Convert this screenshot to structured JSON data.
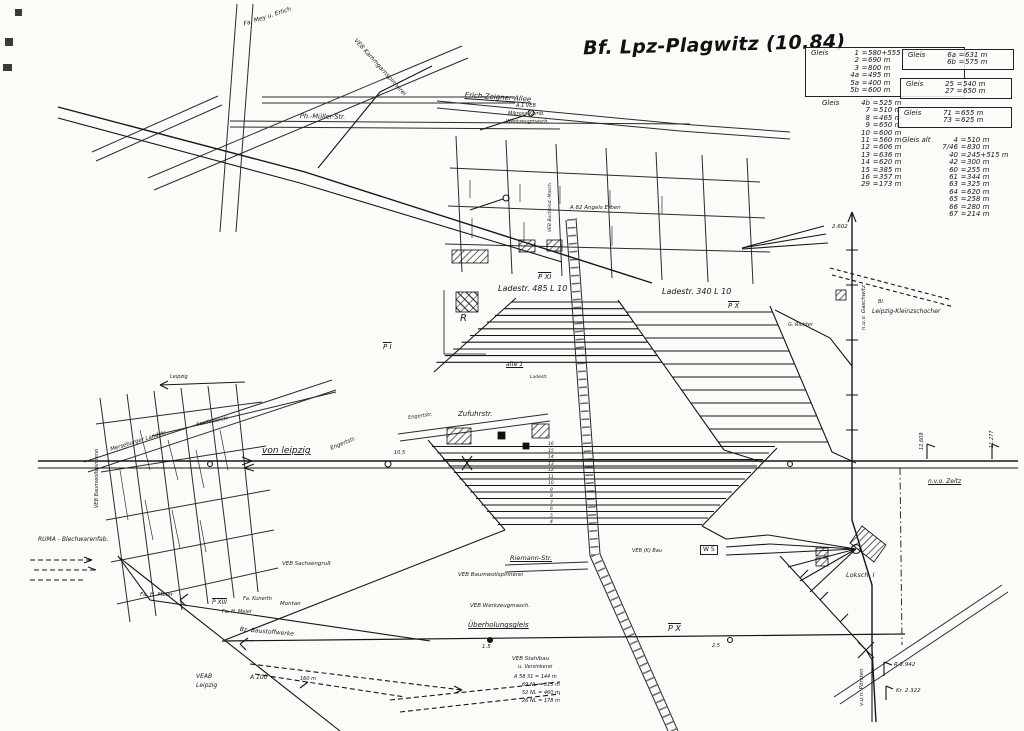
{
  "title": "Bf. Lpz-Plagwitz (10.84)",
  "colors": {
    "ink": "#181818",
    "paper": "#fbfbf8"
  },
  "tables": {
    "gleis_box_1": {
      "heading": "Gleis",
      "rows": [
        [
          "1",
          "580+555 m"
        ],
        [
          "2",
          "690 m"
        ],
        [
          "3",
          "800 m"
        ],
        [
          "4a",
          "495 m"
        ],
        [
          "5a",
          "400 m"
        ],
        [
          "5b",
          "600 m"
        ]
      ]
    },
    "gleis_list_1": {
      "heading": "Gleis",
      "rows": [
        [
          "4b",
          "525 m"
        ],
        [
          "7",
          "510 m"
        ],
        [
          "8",
          "465 m"
        ],
        [
          "9",
          "650 m"
        ],
        [
          "10",
          "600 m"
        ],
        [
          "11",
          "560 m"
        ],
        [
          "12",
          "606 m"
        ],
        [
          "13",
          "636 m"
        ],
        [
          "14",
          "620 m"
        ],
        [
          "15",
          "385 m"
        ],
        [
          "16",
          "357 m"
        ],
        [
          "29",
          "173 m"
        ]
      ]
    },
    "gleis_box_2": {
      "heading": "Gleis",
      "rows": [
        [
          "6a",
          "631 m"
        ],
        [
          "6b",
          "575 m"
        ]
      ]
    },
    "gleis_box_3": {
      "heading": "Gleis",
      "rows": [
        [
          "25",
          "540 m"
        ],
        [
          "27",
          "650 m"
        ]
      ]
    },
    "gleis_box_4": {
      "heading": "Gleis",
      "rows": [
        [
          "71",
          "655 m"
        ],
        [
          "73",
          "625 m"
        ]
      ]
    },
    "gleis_list_2": {
      "heading": "Gleis alt",
      "rows": [
        [
          "4",
          "510 m"
        ],
        [
          "7/46",
          "830 m"
        ],
        [
          "40",
          "245+515 m"
        ],
        [
          "42",
          "300 m"
        ],
        [
          "60",
          "255 m"
        ],
        [
          "61",
          "344 m"
        ],
        [
          "63",
          "325 m"
        ],
        [
          "64",
          "620 m"
        ],
        [
          "65",
          "258 m"
        ],
        [
          "66",
          "280 m"
        ],
        [
          "67",
          "214 m"
        ]
      ]
    }
  },
  "map": {
    "labels": [
      {
        "t": "Erich-Zeigner-Allee",
        "x": 465,
        "y": 92,
        "s": 7,
        "r": 4,
        "u": 1,
        "n": "street-label-erich-zeigner-allee"
      },
      {
        "t": "Ph.-Müller-Str.",
        "x": 300,
        "y": 113,
        "s": 6.5,
        "r": 1,
        "n": "street-label-ph-mueller-str"
      },
      {
        "t": "Fa. Mey u. Erlich",
        "x": 243,
        "y": 22,
        "s": 6,
        "r": -18,
        "n": "factory-label"
      },
      {
        "t": "VEB Kammgarnspinnerei",
        "x": 357,
        "y": 38,
        "s": 6,
        "r": 48,
        "n": "factory-label"
      },
      {
        "t": "A.1 VEB",
        "x": 516,
        "y": 104,
        "s": 5,
        "n": "factory-label"
      },
      {
        "t": "Mikrosa Komb.",
        "x": 508,
        "y": 112,
        "s": 5,
        "n": "factory-label"
      },
      {
        "t": "Werkzeugmasch.",
        "x": 506,
        "y": 120,
        "s": 5,
        "n": "factory-label"
      },
      {
        "t": "A 82 Angels Erben",
        "x": 570,
        "y": 206,
        "s": 5.5,
        "n": "factory-label"
      },
      {
        "t": "VEB Buchbind.-Masch.",
        "x": 549,
        "y": 232,
        "s": 4.5,
        "r": -90,
        "n": "factory-label"
      },
      {
        "t": "Ladestr. 485  L 10",
        "x": 498,
        "y": 285,
        "s": 8,
        "n": "ladestrasse-485-label"
      },
      {
        "t": "Ladestr. 340  L 10",
        "x": 662,
        "y": 288,
        "s": 8,
        "n": "ladestrasse-340-label"
      },
      {
        "t": "P XI",
        "x": 538,
        "y": 274,
        "s": 7,
        "o": 1,
        "n": "post-label-p11"
      },
      {
        "t": "P X",
        "x": 728,
        "y": 303,
        "s": 7,
        "o": 1,
        "n": "post-label-p10"
      },
      {
        "t": "P I",
        "x": 383,
        "y": 344,
        "s": 7,
        "o": 1,
        "n": "post-label-p1"
      },
      {
        "t": "R",
        "x": 460,
        "y": 314,
        "s": 10,
        "n": "ramp-label"
      },
      {
        "t": "alte 1",
        "x": 506,
        "y": 362,
        "s": 6,
        "u": 1,
        "n": "track-label-alte-1"
      },
      {
        "t": "Ladestr.",
        "x": 530,
        "y": 376,
        "s": 4.5,
        "n": "ladestrasse-small-label"
      },
      {
        "t": "Zufuhrstr.",
        "x": 458,
        "y": 411,
        "s": 7,
        "n": "street-label-zufuhrstr"
      },
      {
        "t": "Engertstr.",
        "x": 330,
        "y": 447,
        "s": 5.5,
        "r": -22,
        "n": "street-label-engertstr"
      },
      {
        "t": "Engertstr.",
        "x": 408,
        "y": 416,
        "s": 5,
        "r": -8,
        "n": "street-label-engertstr-2"
      },
      {
        "t": "von leipzig",
        "x": 262,
        "y": 447,
        "s": 9,
        "u": 1,
        "n": "direction-label-von-leipzig"
      },
      {
        "t": "Leipzig",
        "x": 170,
        "y": 375,
        "s": 5,
        "n": "direction-label-leipzig"
      },
      {
        "t": "Merseburger Landstr.",
        "x": 110,
        "y": 448,
        "s": 5.5,
        "r": -17,
        "n": "street-label-merseburger"
      },
      {
        "t": "Saalfelderstr.",
        "x": 196,
        "y": 423,
        "s": 5,
        "r": -12,
        "n": "street-label-saalfelder"
      },
      {
        "t": "VEB Baumwollspinnerei",
        "x": 95,
        "y": 508,
        "s": 5,
        "r": -90,
        "n": "factory-label"
      },
      {
        "t": "RUMA - Blechwarenfab.",
        "x": 38,
        "y": 537,
        "s": 6,
        "n": "factory-label-ruma"
      },
      {
        "t": "Fa. H. Meier",
        "x": 140,
        "y": 593,
        "s": 5.5,
        "n": "factory-label"
      },
      {
        "t": "P XIII",
        "x": 212,
        "y": 600,
        "s": 6,
        "o": 1,
        "n": "post-label-p13"
      },
      {
        "t": "Fa. H. Meier",
        "x": 222,
        "y": 610,
        "s": 5,
        "n": "factory-label"
      },
      {
        "t": "Fa. Kunerth",
        "x": 243,
        "y": 597,
        "s": 5,
        "n": "factory-label"
      },
      {
        "t": "Montan",
        "x": 280,
        "y": 602,
        "s": 5.5,
        "n": "factory-label"
      },
      {
        "t": "VEB Sachsengruß",
        "x": 282,
        "y": 562,
        "s": 5.5,
        "n": "factory-label"
      },
      {
        "t": "Bz. Baustoffwerke",
        "x": 240,
        "y": 627,
        "s": 6,
        "r": 5,
        "n": "factory-label"
      },
      {
        "t": "VEAB",
        "x": 196,
        "y": 674,
        "s": 6,
        "n": "factory-label-veab"
      },
      {
        "t": "Leipzig",
        "x": 196,
        "y": 683,
        "s": 6,
        "n": "factory-label-veab-2"
      },
      {
        "t": "A 100",
        "x": 250,
        "y": 675,
        "s": 6,
        "n": "siding-label-a100"
      },
      {
        "t": "160 m",
        "x": 300,
        "y": 677,
        "s": 5,
        "n": "length-label"
      },
      {
        "t": "Überholungsgleis",
        "x": 468,
        "y": 622,
        "s": 7,
        "u": 1,
        "n": "track-label-ueberholungsgleis"
      },
      {
        "t": "P X",
        "x": 668,
        "y": 625,
        "s": 8,
        "o": 1,
        "n": "post-label-p10-south"
      },
      {
        "t": "2.5",
        "x": 712,
        "y": 644,
        "s": 5,
        "n": "km-label"
      },
      {
        "t": "1.5",
        "x": 482,
        "y": 645,
        "s": 5.5,
        "n": "km-label"
      },
      {
        "t": "10.5",
        "x": 394,
        "y": 451,
        "s": 5,
        "n": "km-label"
      },
      {
        "t": "VEB Baumwollspinnerei",
        "x": 458,
        "y": 573,
        "s": 5.5,
        "n": "factory-label"
      },
      {
        "t": "VEB Werkzeugmasch.",
        "x": 470,
        "y": 604,
        "s": 5.5,
        "n": "factory-label"
      },
      {
        "t": "Riemann-Str.",
        "x": 510,
        "y": 555,
        "s": 6.5,
        "u": 1,
        "n": "street-label-riemann"
      },
      {
        "t": "VEB Stahlbau",
        "x": 512,
        "y": 657,
        "s": 5.5,
        "n": "factory-label"
      },
      {
        "t": "u. Verzinkerei",
        "x": 518,
        "y": 665,
        "s": 5,
        "n": "factory-label"
      },
      {
        "t": "A 58  31 = 144 m",
        "x": 514,
        "y": 675,
        "s": 5,
        "n": "length-list-row"
      },
      {
        "t": "69  NL = 315 m",
        "x": 522,
        "y": 683,
        "s": 5,
        "n": "length-list-row"
      },
      {
        "t": "52  NL = 460 m",
        "x": 522,
        "y": 691,
        "s": 5,
        "n": "length-list-row"
      },
      {
        "t": "26  NL = 178 m",
        "x": 522,
        "y": 699,
        "s": 5,
        "n": "length-list-row"
      },
      {
        "t": "W 5",
        "x": 700,
        "y": 545,
        "s": 6,
        "box": 1,
        "n": "switch-label-w5"
      },
      {
        "t": "VEB (K) Bau",
        "x": 632,
        "y": 549,
        "s": 5,
        "n": "factory-label"
      },
      {
        "t": "Loksch. I",
        "x": 846,
        "y": 572,
        "s": 6.5,
        "n": "loco-shed-label"
      },
      {
        "t": "v.u.n. Pörsten",
        "x": 860,
        "y": 706,
        "s": 5.5,
        "r": -90,
        "n": "direction-label-poersten"
      },
      {
        "t": "R 2.942",
        "x": 894,
        "y": 663,
        "s": 5.5,
        "n": "km-label"
      },
      {
        "t": "Kr. 2.322",
        "x": 896,
        "y": 689,
        "s": 5.5,
        "n": "km-label"
      },
      {
        "t": "n.u.v. Gaschwitz",
        "x": 862,
        "y": 330,
        "s": 5.5,
        "r": -90,
        "n": "direction-label-gaschwitz"
      },
      {
        "t": "2.602",
        "x": 832,
        "y": 225,
        "s": 5.5,
        "n": "km-label"
      },
      {
        "t": "Bl.",
        "x": 878,
        "y": 300,
        "s": 5,
        "n": "block-post-label"
      },
      {
        "t": "Leipzig-Kleinzschocher",
        "x": 872,
        "y": 309,
        "s": 6,
        "n": "station-label-kleinzschocher"
      },
      {
        "t": "G. Richter",
        "x": 788,
        "y": 323,
        "s": 5,
        "n": "factory-label"
      },
      {
        "t": "n.v.o. Zeitz",
        "x": 928,
        "y": 479,
        "s": 6,
        "u": 1,
        "n": "direction-label-zeitz"
      },
      {
        "t": "12.609",
        "x": 920,
        "y": 450,
        "s": 5,
        "r": -90,
        "n": "km-label"
      },
      {
        "t": "11.277",
        "x": 990,
        "y": 448,
        "s": 5,
        "r": -90,
        "n": "km-label"
      },
      {
        "t": "16",
        "x": 548,
        "y": 443,
        "s": 4.5,
        "n": "track-number"
      },
      {
        "t": "15",
        "x": 548,
        "y": 449.5,
        "s": 4.5,
        "n": "track-number"
      },
      {
        "t": "14",
        "x": 548,
        "y": 456,
        "s": 4.5,
        "n": "track-number"
      },
      {
        "t": "13",
        "x": 548,
        "y": 462.5,
        "s": 4.5,
        "n": "track-number"
      },
      {
        "t": "12",
        "x": 548,
        "y": 469,
        "s": 4.5,
        "n": "track-number"
      },
      {
        "t": "11",
        "x": 548,
        "y": 475.5,
        "s": 4.5,
        "n": "track-number"
      },
      {
        "t": "10",
        "x": 548,
        "y": 482,
        "s": 4.5,
        "n": "track-number"
      },
      {
        "t": "9",
        "x": 550,
        "y": 488.5,
        "s": 4.5,
        "n": "track-number"
      },
      {
        "t": "8",
        "x": 550,
        "y": 495,
        "s": 4.5,
        "n": "track-number"
      },
      {
        "t": "7",
        "x": 550,
        "y": 501.5,
        "s": 4.5,
        "n": "track-number"
      },
      {
        "t": "6",
        "x": 550,
        "y": 508,
        "s": 4.5,
        "n": "track-number"
      },
      {
        "t": "5",
        "x": 550,
        "y": 514.5,
        "s": 4.5,
        "n": "track-number"
      },
      {
        "t": "4",
        "x": 550,
        "y": 521,
        "s": 4.5,
        "n": "track-number"
      }
    ]
  }
}
